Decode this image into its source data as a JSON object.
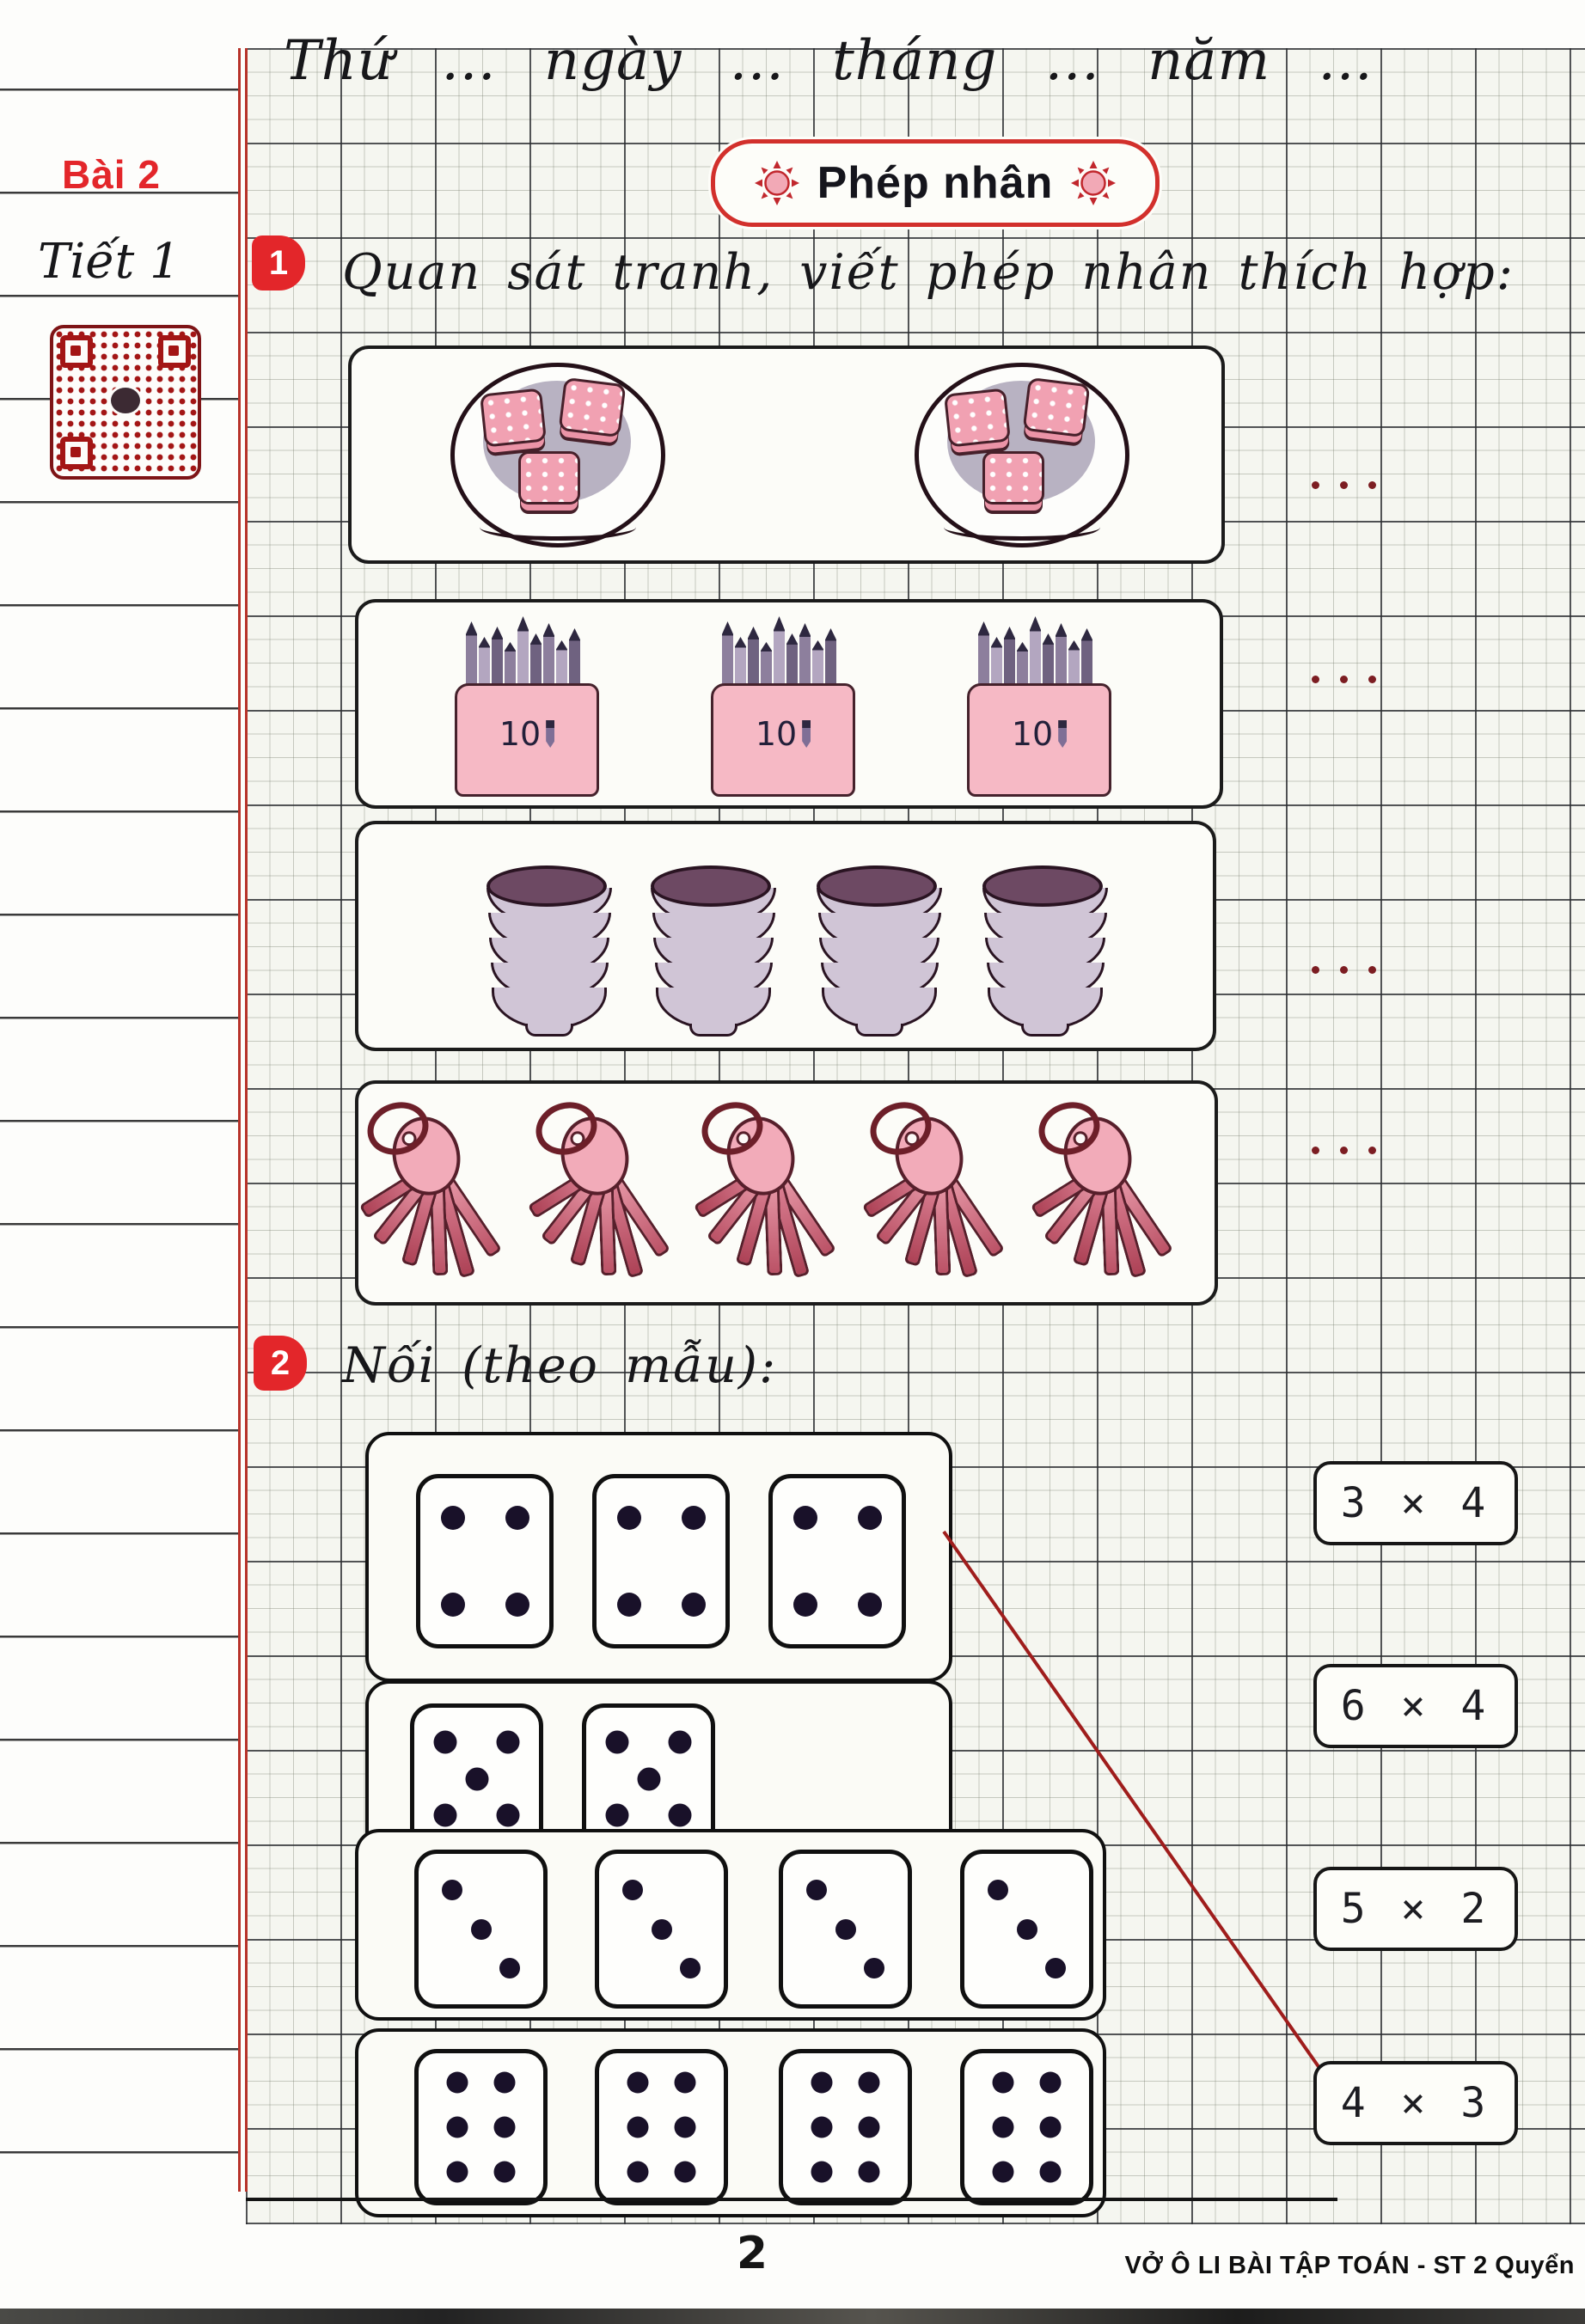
{
  "page": {
    "header_line": "Thứ ... ngày ... tháng ... năm ...",
    "lesson_label": "Bài 2",
    "period_label": "Tiết 1",
    "title": "Phép nhân",
    "page_number": "2",
    "footer": "VỞ Ô LI BÀI TẬP TOÁN - ST 2 Quyển",
    "colors": {
      "accent_red": "#e3262a",
      "title_border_red": "#d2302c",
      "qr_red": "#a31515",
      "connector_red": "#9f1d1c",
      "pink": "#f2abb9",
      "bowl_mauve": "#d0c5d6",
      "pencil_purple": "#8d7f9d"
    }
  },
  "exercise1": {
    "number": "1",
    "instruction": "Quan sát tranh, viết phép nhân thích hợp:",
    "pictures": [
      {
        "name": "plates-of-biscuits",
        "groups": 2,
        "items_per_group": 3,
        "answer_placeholder": "· · ·"
      },
      {
        "name": "pencil-boxes",
        "groups": 3,
        "items_per_group": 10,
        "box_label": "10",
        "answer_placeholder": "· · ·"
      },
      {
        "name": "bowl-stacks",
        "groups": 4,
        "items_per_group": 5,
        "answer_placeholder": "· · ·"
      },
      {
        "name": "key-rings",
        "groups": 5,
        "items_per_group": 6,
        "answer_placeholder": "· · ·"
      }
    ]
  },
  "exercise2": {
    "number": "2",
    "instruction": "Nối (theo mẫu):",
    "dice_rows": [
      {
        "dice_count": 3,
        "pips_per_die": 4
      },
      {
        "dice_count": 2,
        "pips_per_die": 5
      },
      {
        "dice_count": 4,
        "pips_per_die": 3
      },
      {
        "dice_count": 4,
        "pips_per_die": 6
      }
    ],
    "answers": [
      "3 × 4",
      "6 × 4",
      "5 × 2",
      "4 × 3"
    ],
    "example_connection": {
      "from_row_index": 0,
      "to_answer": "4 × 3"
    }
  }
}
